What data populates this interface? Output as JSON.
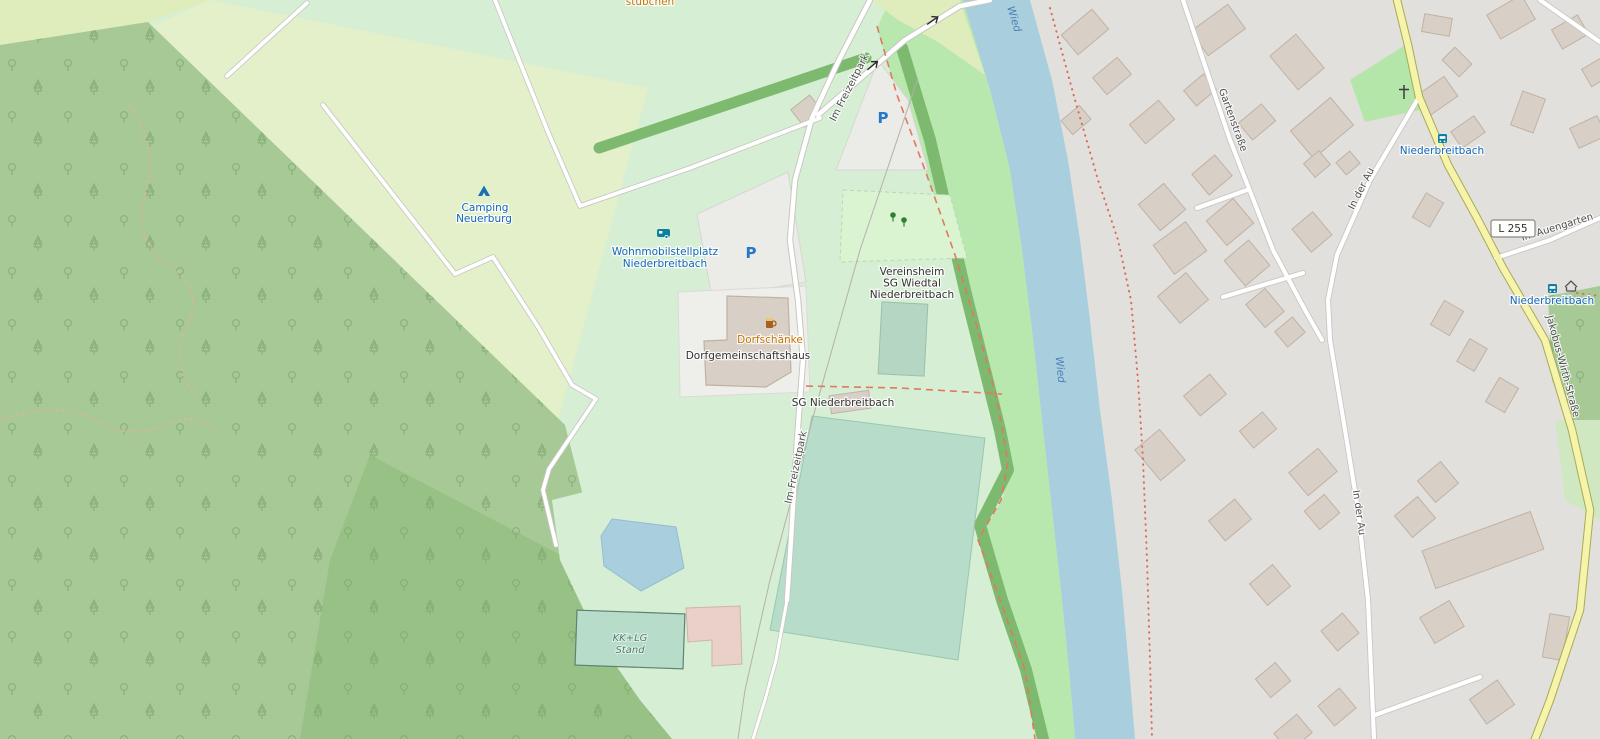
{
  "map": {
    "pois": {
      "stuebchen_partial": "stübchen",
      "camping_line1": "Camping",
      "camping_line2": "Neuerburg",
      "womo_line1": "Wohnmobilstellplatz",
      "womo_line2": "Niederbreitbach",
      "parking_symbol": "P",
      "dorfschaenke": "Dorfschänke",
      "dorfgemeinschaftshaus": "Dorfgemeinschaftshaus",
      "vereinsheim_line1": "Vereinsheim",
      "vereinsheim_line2": "SG Wiedtal",
      "vereinsheim_line3": "Niederbreitbach",
      "sg_niederbreitbach": "SG Niederbreitbach",
      "kklg_line1": "KK+LG",
      "kklg_line2": "Stand"
    },
    "streets": {
      "im_freizeitpark": "Im Freizeitpark",
      "gartenstrasse": "Gartenstraße",
      "in_der_au": "In der Au",
      "jakobus_wirth": "Jakobus-Wirth-Straße",
      "im_auengarten": "Im Auengarten"
    },
    "river": "Wied",
    "bus_stop": "Niederbreitbach",
    "road_ref": "L 255",
    "colors": {
      "forest": "#a6c996",
      "forest_dark": "#98c285",
      "camping": "#e3f0c9",
      "meadow": "#d6efd4",
      "grass_band": "#b9e8ae",
      "park": "#b4e6a9",
      "scrub": "#dfecbb",
      "pitch": "#b7dcc9",
      "hedge": "#7db96e",
      "water": "#a9cedd",
      "residential": "#e2e0dd",
      "building": "#d8cfc7",
      "road_secondary": "#f6f3ab",
      "boundary_red": "#e0795f",
      "poi_blue": "#1a6fb5",
      "transit_teal": "#0e7f9e",
      "poi_orange": "#c77400"
    }
  }
}
